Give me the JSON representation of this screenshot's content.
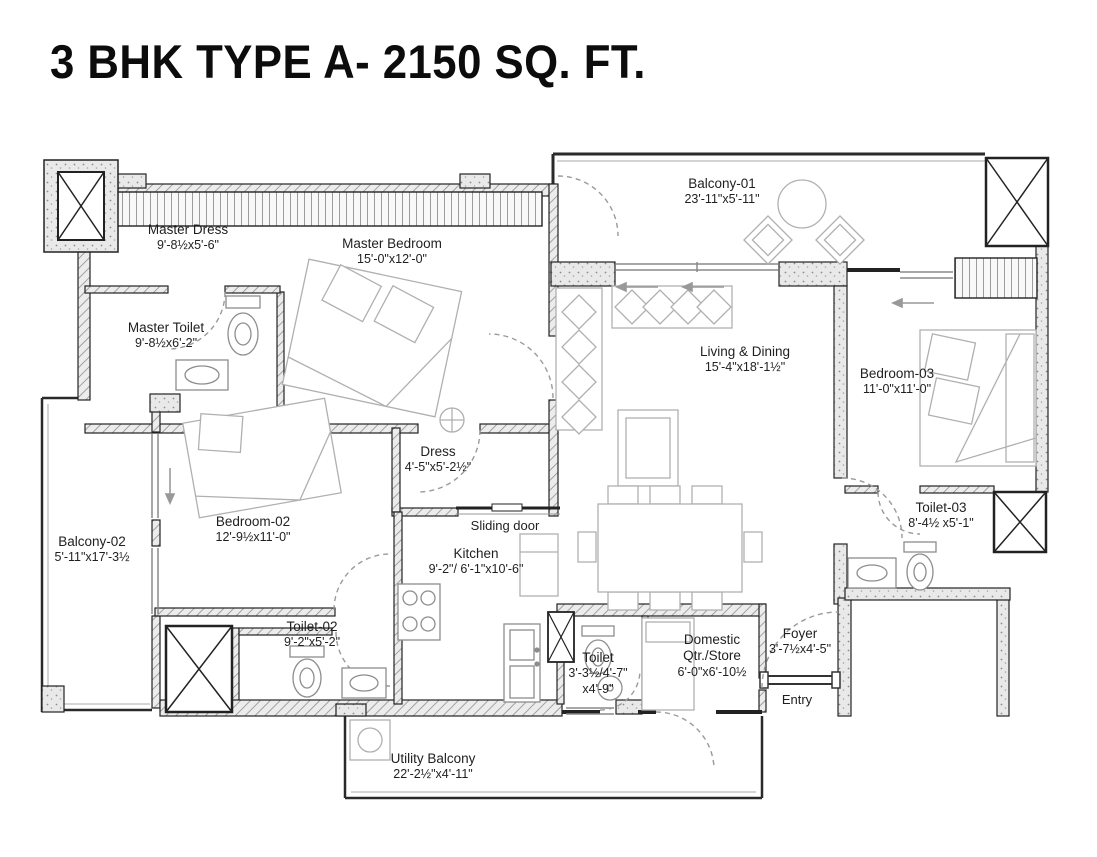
{
  "title": "3 BHK TYPE A- 2150 SQ. FT.",
  "rooms": [
    {
      "name": "Master Dress",
      "dims": "9'-8½x5'-6\""
    },
    {
      "name": "Master Bedroom",
      "dims": "15'-0\"x12'-0\""
    },
    {
      "name": "Master Toilet",
      "dims": "9'-8½x6'-2\""
    },
    {
      "name": "Balcony-01",
      "dims": "23'-11\"x5'-11\""
    },
    {
      "name": "Living & Dining",
      "dims": "15'-4\"x18'-1½\""
    },
    {
      "name": "Bedroom-03",
      "dims": "11'-0\"x11'-0\""
    },
    {
      "name": "Dress",
      "dims": "4'-5\"x5'-2½\""
    },
    {
      "name": "Bedroom-02",
      "dims": "12'-9½x11'-0\""
    },
    {
      "name": "Balcony-02",
      "dims": "5'-11\"x17'-3½"
    },
    {
      "name": "Kitchen",
      "dims": "9'-2\"/ 6'-1\"x10'-6\""
    },
    {
      "name": "Toilet-02",
      "dims": "9'-2\"x5'-2\""
    },
    {
      "name": "Toilet",
      "dims": "3'-3½/4'-7\"",
      "dims2": "x4'-9\""
    },
    {
      "name": "Domestic Qtr./Store",
      "dims": "6'-0\"x6'-10½"
    },
    {
      "name": "Foyer",
      "dims": "3'-7½x4'-5\""
    },
    {
      "name": "Toilet-03",
      "dims": "8'-4½ x5'-1\""
    },
    {
      "name": "Utility Balcony",
      "dims": "22'-2½\"x4'-11\""
    }
  ],
  "annotations": {
    "sliding_door": "Sliding door",
    "entry": "Entry"
  },
  "colors": {
    "ink": "#1c1c1c",
    "furniture_line": "#b0b0b0",
    "background": "#ffffff"
  }
}
